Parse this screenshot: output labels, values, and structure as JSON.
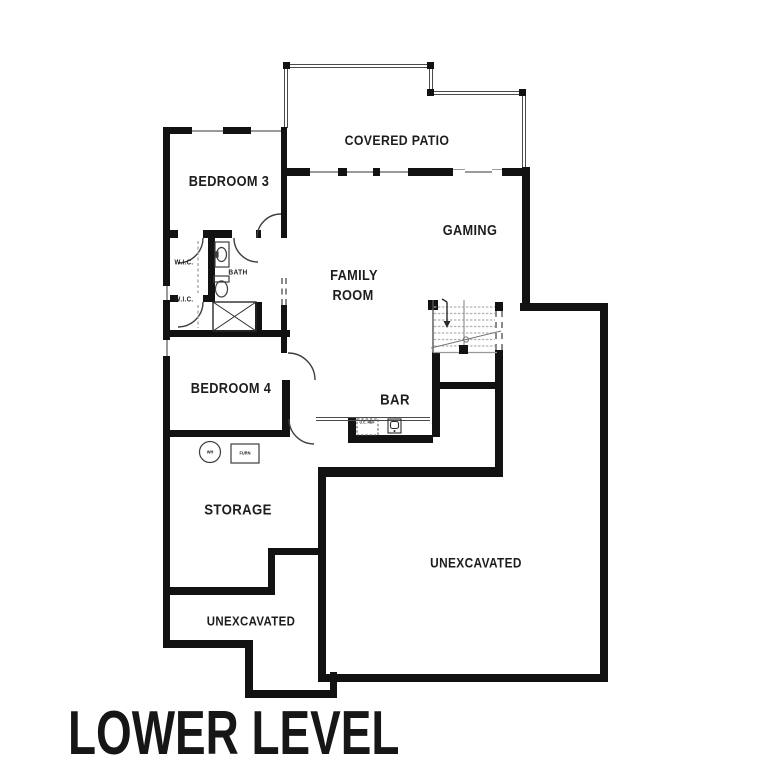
{
  "title": "LOWER LEVEL",
  "rooms": {
    "covered_patio": "COVERED PATIO",
    "bedroom3": "BEDROOM 3",
    "gaming": "GAMING",
    "family_line1": "FAMILY",
    "family_line2": "ROOM",
    "wic1": "W.I.C.",
    "wic2": "W.I.C.",
    "bath": "BATH",
    "bedroom4": "BEDROOM 4",
    "bar": "BAR",
    "storage": "STORAGE",
    "unexcavated_left": "UNEXCAVATED",
    "unexcavated_right": "UNEXCAVATED"
  },
  "fixtures": {
    "water_heater": "WH",
    "furnace": "FURN",
    "under_counter_fridge": "U.C. REF"
  },
  "colors": {
    "wall": "#121212",
    "window": "#9a9a9a",
    "tread": "#b0b0b0",
    "line": "#4a4a4a",
    "text": "#1d1d1d",
    "background": "#ffffff"
  }
}
